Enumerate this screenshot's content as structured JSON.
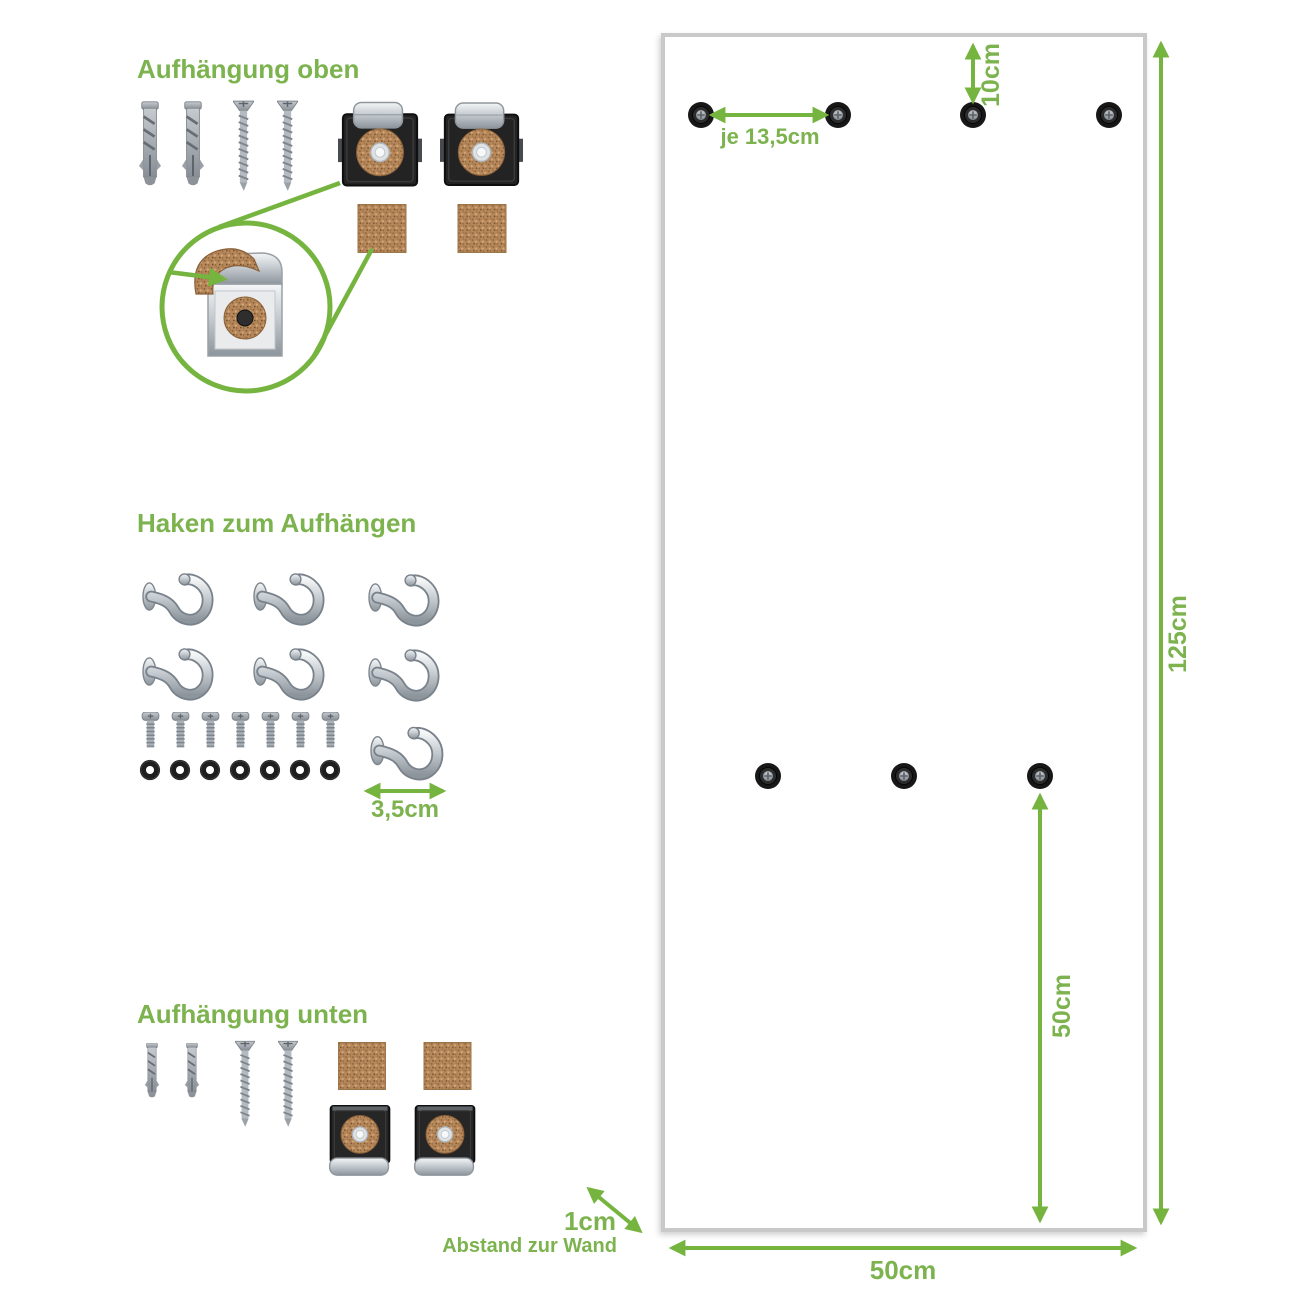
{
  "sections": {
    "top": {
      "title": "Aufhängung oben",
      "dowel_count": 2,
      "screw_count": 2,
      "clip_count": 2,
      "cork_pad_count": 2
    },
    "hooks": {
      "title": "Haken zum Aufhängen",
      "hook_count": 7,
      "bolt_count": 7,
      "washer_count": 7,
      "hook_width_label": "3,5cm"
    },
    "bottom": {
      "title": "Aufhängung unten",
      "dowel_count": 2,
      "screw_count": 2,
      "clip_count": 2,
      "cork_pad_count": 2
    }
  },
  "panel": {
    "top_hole_count": 4,
    "mid_hole_count": 3,
    "labels": {
      "hole_spacing": "je 13,5cm",
      "top_offset": "10cm",
      "height": "125cm",
      "bottom_segment": "50cm",
      "width": "50cm",
      "wall_gap": "1cm",
      "wall_gap_caption": "Abstand zur Wand"
    }
  },
  "colors": {
    "green": "#7cb34e",
    "arrow_green": "#76b440",
    "cork": "#b5875a",
    "panel_border": "#c9c9c9"
  }
}
